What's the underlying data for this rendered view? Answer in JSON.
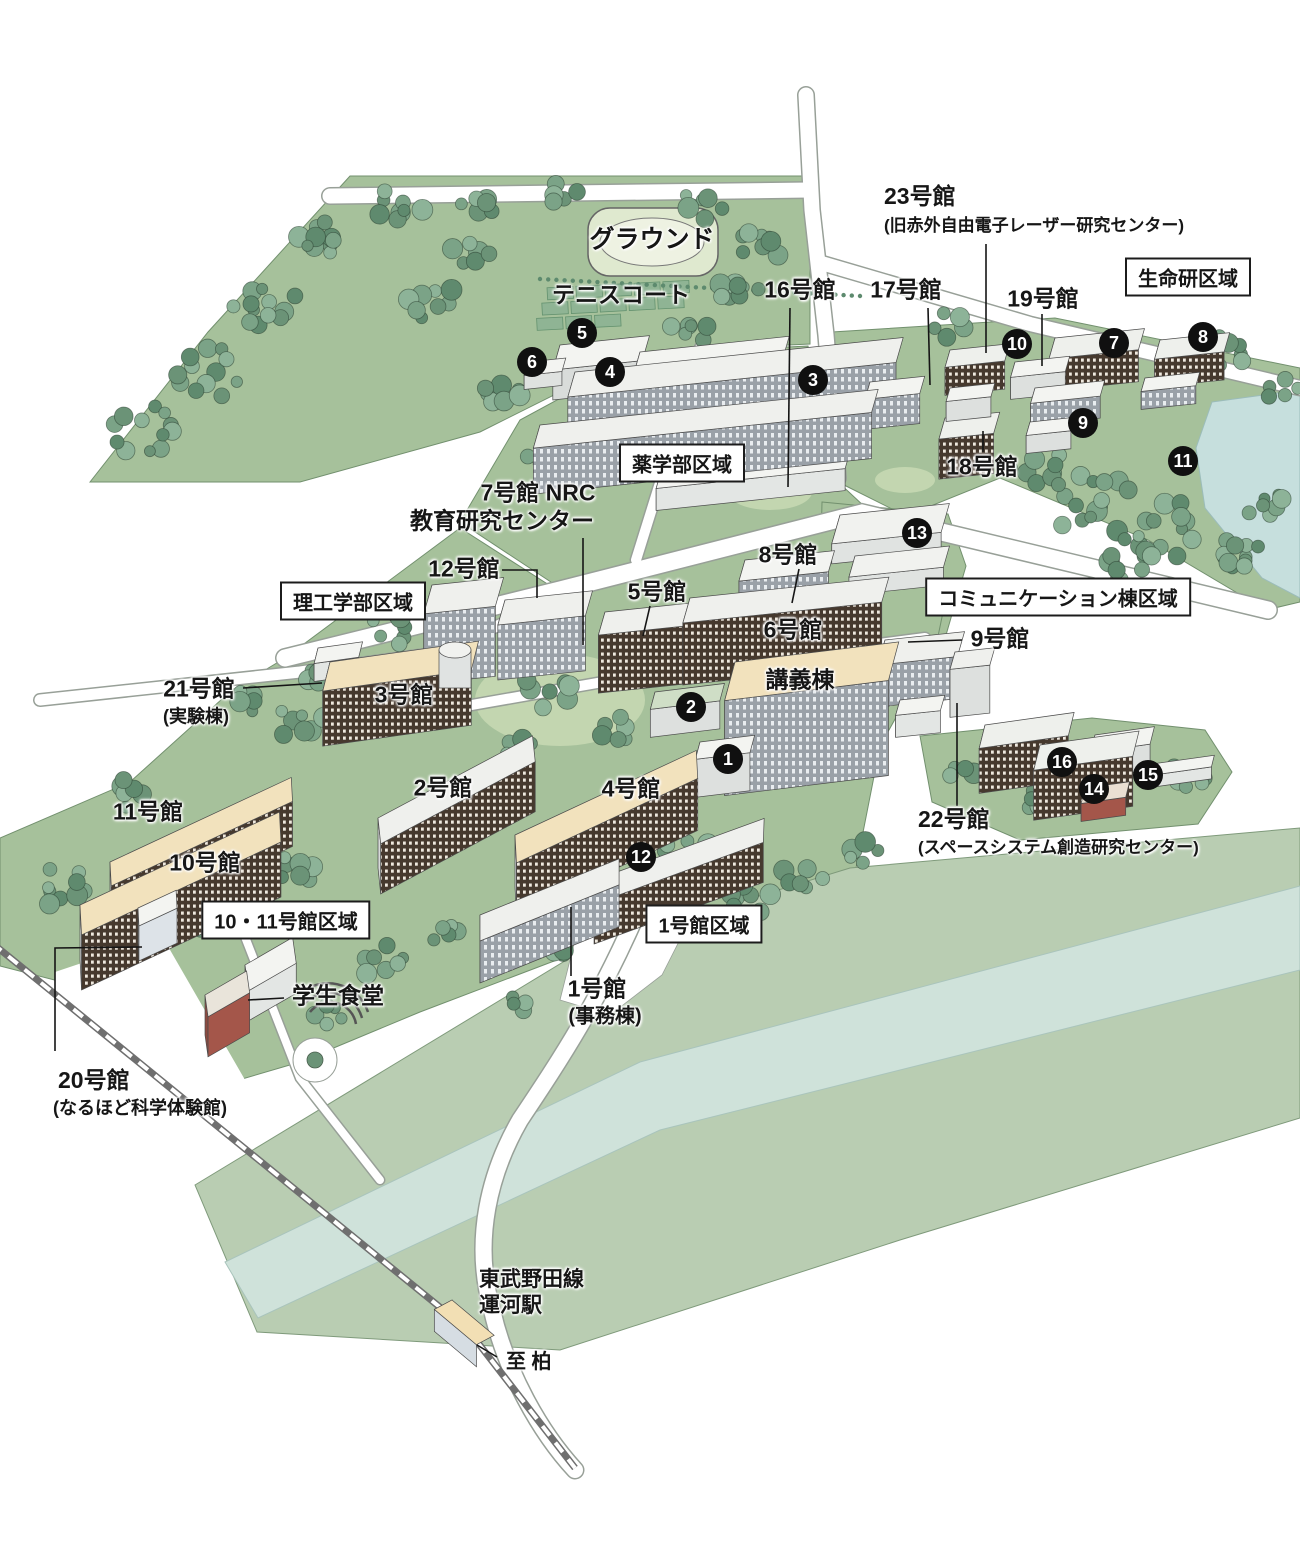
{
  "map_title": "キャンパスマップ",
  "palette": {
    "campus_green": "#a6c19b",
    "lawn_light": "#c3d6b0",
    "field_pale": "#e6edd7",
    "forest_green": "#6b9377",
    "river_band": "#b9cdb2",
    "river_stripe": "#cfe2da",
    "pond_blue": "#c6dfdd",
    "road_white": "#ffffff",
    "building_dark_facade": "#46392e",
    "roof_cream": "#f2e2bd",
    "accent_red_building": "#a4564a",
    "marker_black": "#101010"
  },
  "area_boxes": [
    {
      "text": "生命研区域",
      "x": 1188,
      "y": 277
    },
    {
      "text": "薬学部区域",
      "x": 682,
      "y": 463
    },
    {
      "text": "コミュニケーション棟区域",
      "x": 1058,
      "y": 597
    },
    {
      "text": "理工学部区域",
      "x": 353,
      "y": 601
    },
    {
      "text": "10・11号館区域",
      "x": 286,
      "y": 920
    },
    {
      "text": "1号館区域",
      "x": 704,
      "y": 924
    }
  ],
  "labels": [
    {
      "text": "グラウンド",
      "x": 652,
      "y": 241,
      "size": 25,
      "anchor": "center"
    },
    {
      "text": "テニスコート",
      "x": 621,
      "y": 296,
      "size": 23,
      "anchor": "center"
    },
    {
      "text": "16号館",
      "x": 800,
      "y": 291,
      "size": 23,
      "anchor": "center"
    },
    {
      "text": "17号館",
      "x": 906,
      "y": 291,
      "size": 23,
      "anchor": "center"
    },
    {
      "text": "23号館",
      "x": 884,
      "y": 198,
      "size": 23,
      "anchor": "left"
    },
    {
      "text": "(旧赤外自由電子レーザー研究センター)",
      "x": 884,
      "y": 227,
      "size": 17,
      "anchor": "left"
    },
    {
      "text": "19号館",
      "x": 1043,
      "y": 300,
      "size": 23,
      "anchor": "center"
    },
    {
      "text": "18号館",
      "x": 982,
      "y": 468,
      "size": 23,
      "anchor": "center"
    },
    {
      "text": "7号館 NRC",
      "x": 538,
      "y": 494,
      "size": 23,
      "anchor": "center"
    },
    {
      "text": "教育研究センター",
      "x": 502,
      "y": 522,
      "size": 23,
      "anchor": "center"
    },
    {
      "text": "12号館",
      "x": 464,
      "y": 570,
      "size": 23,
      "anchor": "center"
    },
    {
      "text": "8号館",
      "x": 788,
      "y": 556,
      "size": 23,
      "anchor": "center"
    },
    {
      "text": "5号館",
      "x": 657,
      "y": 593,
      "size": 23,
      "anchor": "center"
    },
    {
      "text": "6号館",
      "x": 793,
      "y": 631,
      "size": 23,
      "anchor": "center"
    },
    {
      "text": "9号館",
      "x": 1000,
      "y": 640,
      "size": 23,
      "anchor": "center"
    },
    {
      "text": "21号館",
      "x": 199,
      "y": 690,
      "size": 23,
      "anchor": "center"
    },
    {
      "text": "(実験棟)",
      "x": 196,
      "y": 718,
      "size": 18,
      "anchor": "center"
    },
    {
      "text": "3号館",
      "x": 404,
      "y": 696,
      "size": 23,
      "anchor": "center"
    },
    {
      "text": "講義棟",
      "x": 800,
      "y": 681,
      "size": 23,
      "anchor": "center"
    },
    {
      "text": "2号館",
      "x": 443,
      "y": 789,
      "size": 23,
      "anchor": "center"
    },
    {
      "text": "4号館",
      "x": 631,
      "y": 790,
      "size": 23,
      "anchor": "center"
    },
    {
      "text": "22号館",
      "x": 918,
      "y": 821,
      "size": 23,
      "anchor": "left"
    },
    {
      "text": "(スペースシステム創造研究センター)",
      "x": 918,
      "y": 849,
      "size": 17,
      "anchor": "left"
    },
    {
      "text": "11号館",
      "x": 148,
      "y": 813,
      "size": 23,
      "anchor": "center"
    },
    {
      "text": "10号館",
      "x": 205,
      "y": 864,
      "size": 23,
      "anchor": "center"
    },
    {
      "text": "学生食堂",
      "x": 338,
      "y": 997,
      "size": 23,
      "anchor": "center"
    },
    {
      "text": "1号館",
      "x": 597,
      "y": 990,
      "size": 23,
      "anchor": "center"
    },
    {
      "text": "(事務棟)",
      "x": 605,
      "y": 1018,
      "size": 20,
      "anchor": "center"
    },
    {
      "text": "20号館",
      "x": 58,
      "y": 1082,
      "size": 23,
      "anchor": "left"
    },
    {
      "text": "(なるほど科学体験館)",
      "x": 53,
      "y": 1110,
      "size": 18,
      "anchor": "left"
    },
    {
      "text": "東武野田線",
      "x": 479,
      "y": 1282,
      "size": 21,
      "anchor": "left"
    },
    {
      "text": "運河駅",
      "x": 479,
      "y": 1308,
      "size": 21,
      "anchor": "left"
    },
    {
      "text": "至 柏",
      "x": 506,
      "y": 1364,
      "size": 20,
      "anchor": "left"
    }
  ],
  "markers": [
    {
      "n": "1",
      "x": 728,
      "y": 759
    },
    {
      "n": "2",
      "x": 691,
      "y": 707
    },
    {
      "n": "3",
      "x": 813,
      "y": 380
    },
    {
      "n": "4",
      "x": 610,
      "y": 372
    },
    {
      "n": "5",
      "x": 582,
      "y": 333
    },
    {
      "n": "6",
      "x": 532,
      "y": 362
    },
    {
      "n": "7",
      "x": 1114,
      "y": 343
    },
    {
      "n": "8",
      "x": 1203,
      "y": 337
    },
    {
      "n": "9",
      "x": 1083,
      "y": 423
    },
    {
      "n": "10",
      "x": 1017,
      "y": 344
    },
    {
      "n": "11",
      "x": 1183,
      "y": 461
    },
    {
      "n": "12",
      "x": 641,
      "y": 857
    },
    {
      "n": "13",
      "x": 917,
      "y": 533
    },
    {
      "n": "14",
      "x": 1094,
      "y": 789
    },
    {
      "n": "15",
      "x": 1148,
      "y": 775
    },
    {
      "n": "16",
      "x": 1062,
      "y": 762
    }
  ]
}
